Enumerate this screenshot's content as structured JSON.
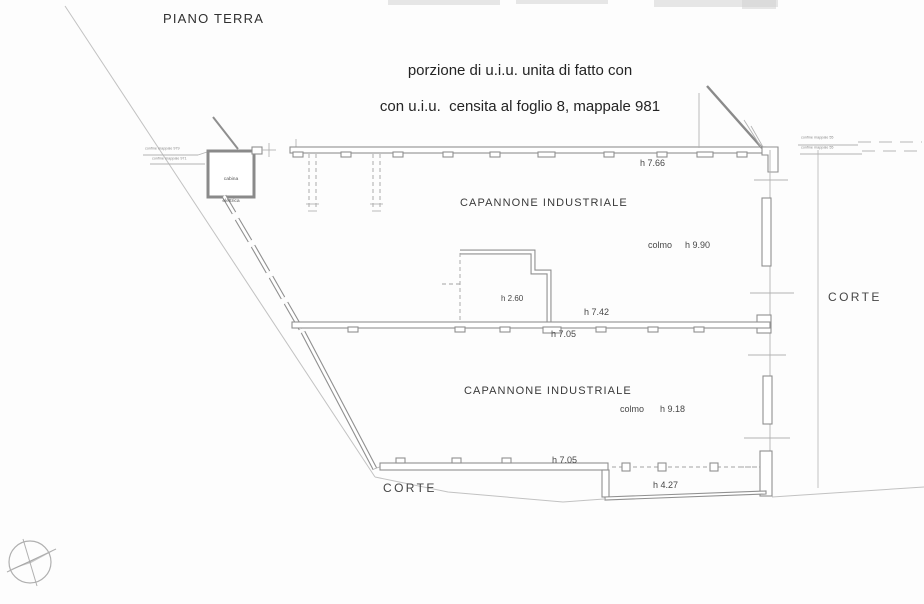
{
  "page_title": "PIANO TERRA",
  "annotation": {
    "line1": "porzione di u.i.u. unita di fatto con",
    "line2": "con u.i.u.  censita al foglio 8, mappale 981"
  },
  "cabina": {
    "line1": "cabina",
    "line2": "elettrica"
  },
  "boundaries": {
    "left_note1": "confine mappale 979",
    "left_note2": "confine mappale 971",
    "right_note1": "confine mappale 55",
    "right_note2": "confine mappale 55"
  },
  "upper_hall": {
    "name": "CAPANNONE INDUSTRIALE",
    "eave_height": "h 7.66",
    "ridge_word": "colmo",
    "ridge_height": "h 9.90",
    "room_height": "h 2.60",
    "height_right": "h 7.42",
    "height_mid": "h 7.05"
  },
  "lower_hall": {
    "name": "CAPANNONE INDUSTRIALE",
    "ridge_word": "colmo",
    "ridge_height": "h 9.18",
    "height_bottom": "h 7.05",
    "canopy_height": "h 4.27"
  },
  "courtyard_right": "CORTE",
  "courtyard_bottom": "CORTE",
  "colors": {
    "line": "#9a9a9a",
    "wall": "#8f8f8f",
    "text": "#3d3d3d"
  }
}
